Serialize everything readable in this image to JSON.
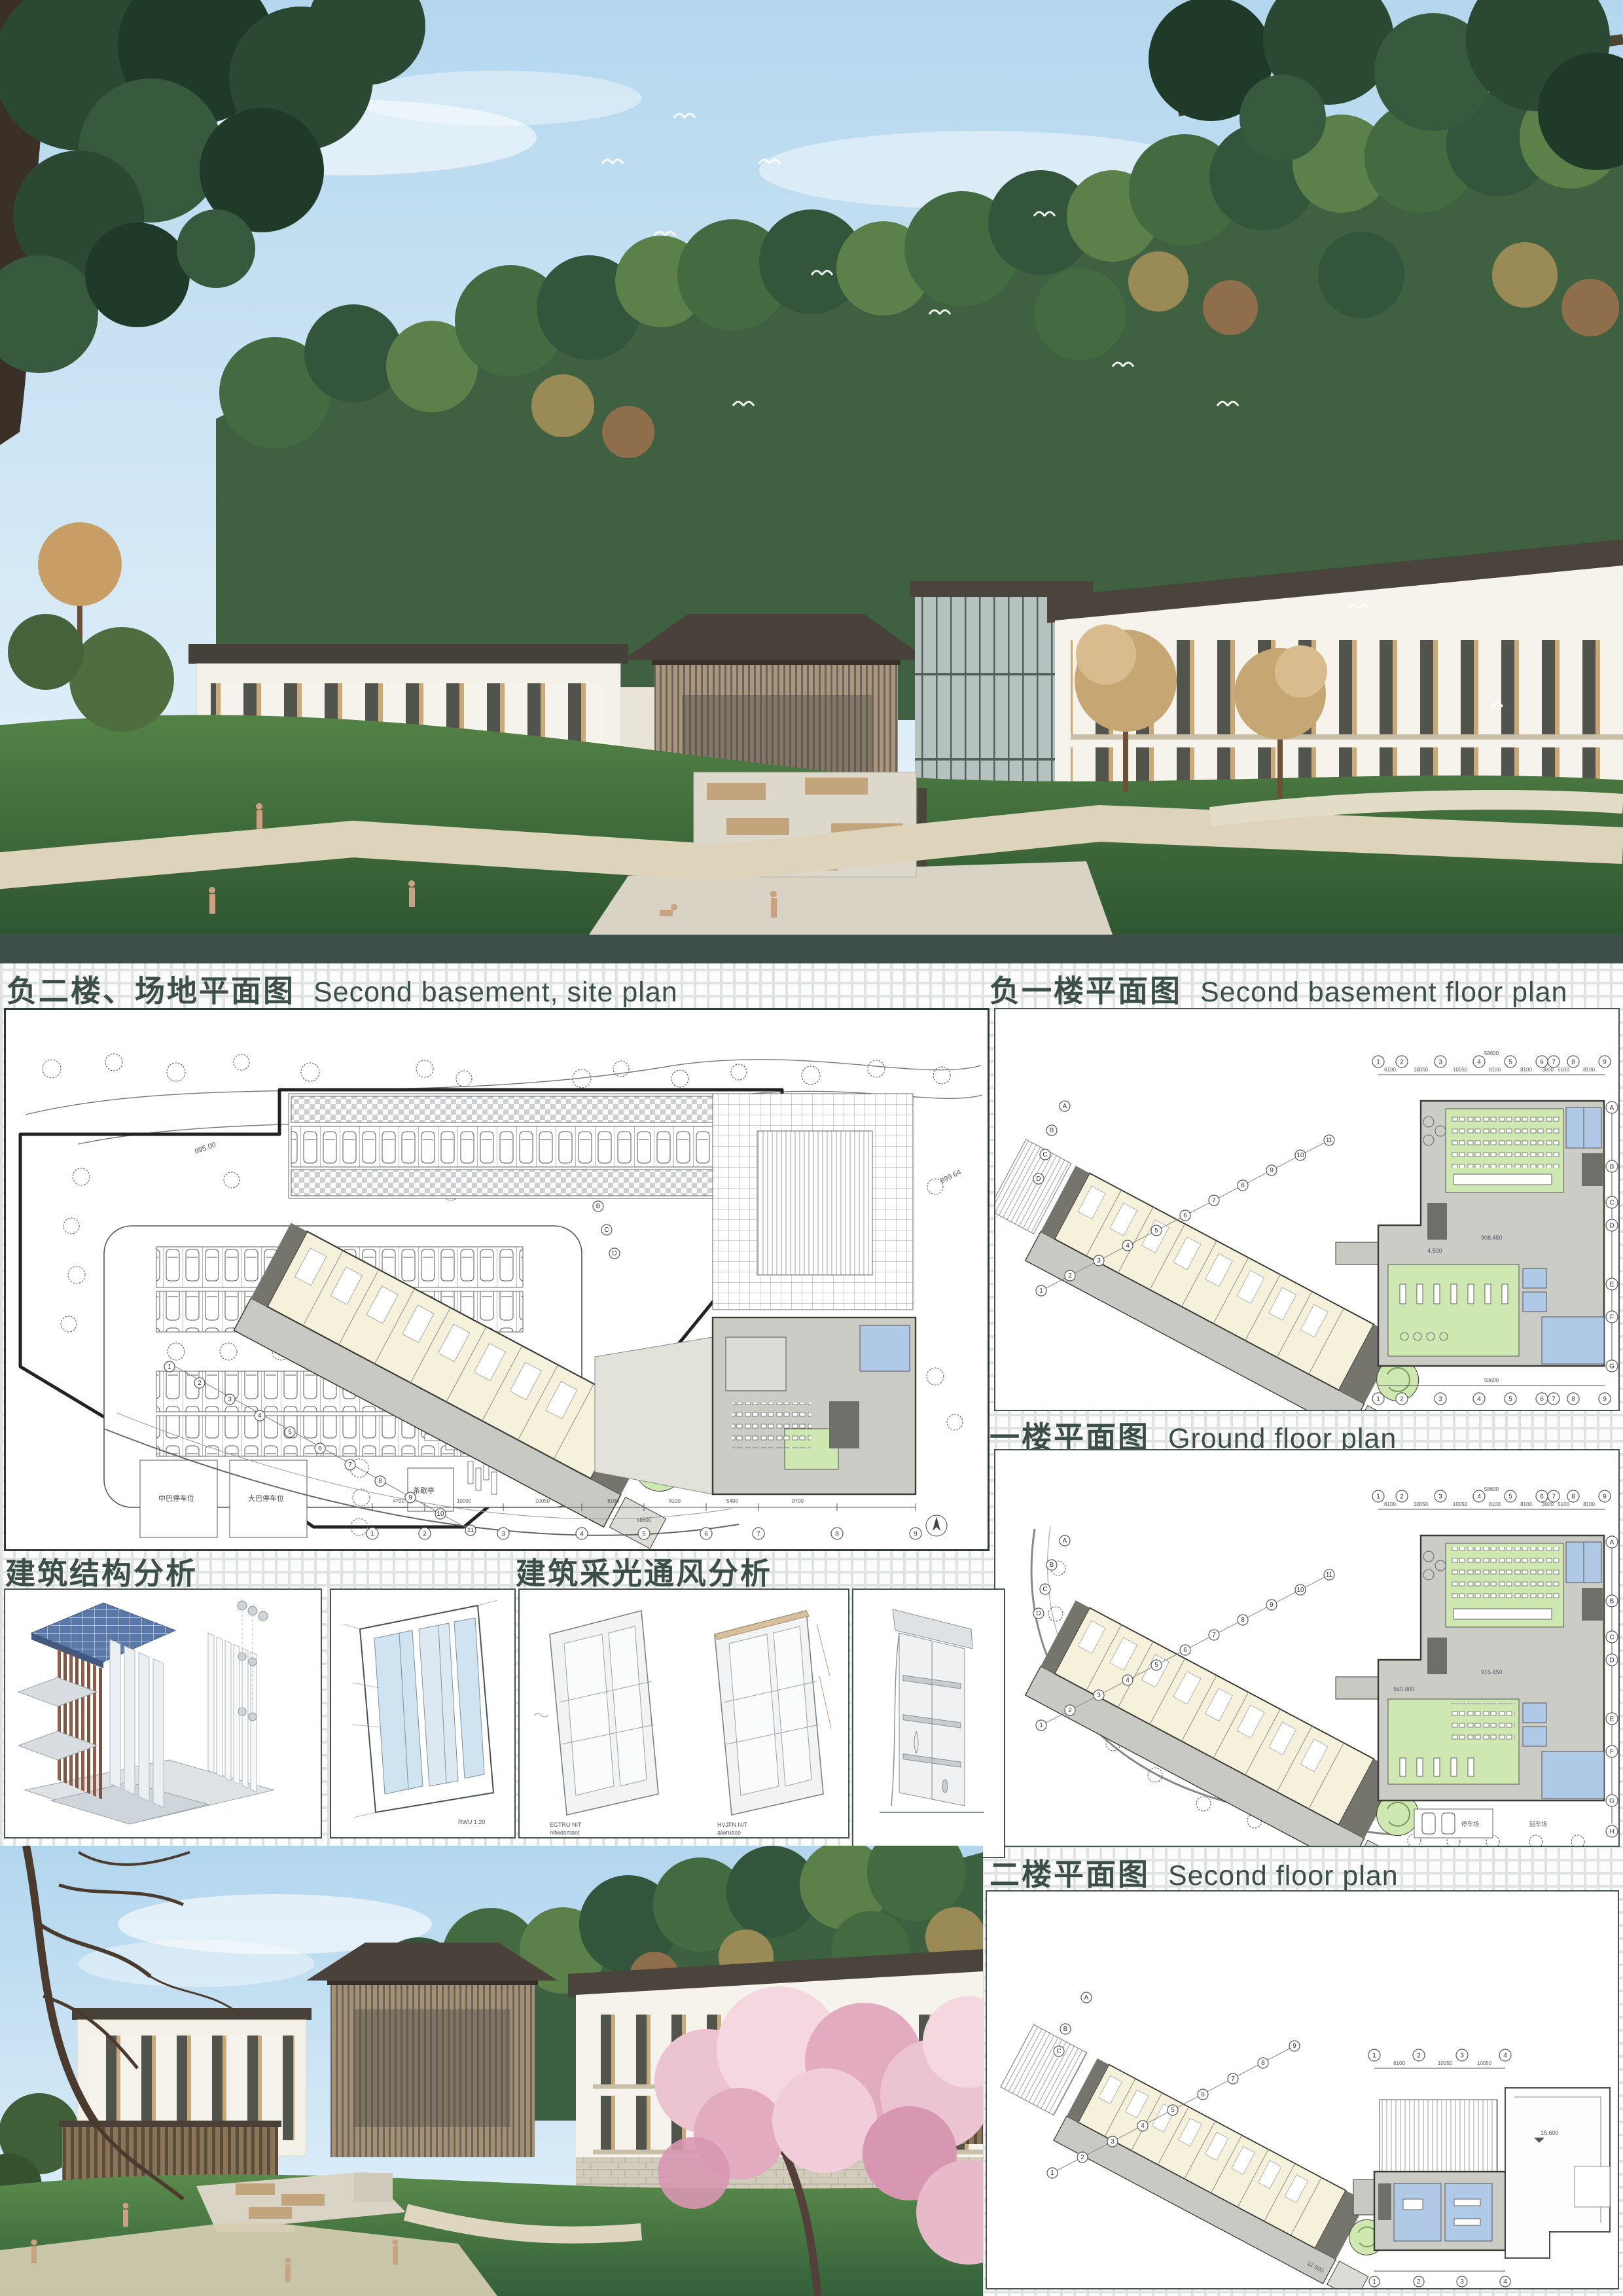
{
  "colors": {
    "divider_teal": "#3e4f4a",
    "title_text": "#3b4e47",
    "grid_line": "#dfe4e0",
    "sky": "#b4d7ee",
    "lawn": "#47713f",
    "blossom_pink": "#ecc3d1",
    "plan_cream": "#f5f1da",
    "plan_green": "#cfe7b1",
    "plan_blue": "#afc9e7",
    "plan_grey": "#c9c9c4"
  },
  "titles": {
    "site_cn": "负二楼、场地平面图",
    "site_en": "Second basement, site plan",
    "b1_cn": "负一楼平面图",
    "b1_en": "Second basement floor plan",
    "ground_cn": "一楼平面图",
    "ground_en": "Ground floor plan",
    "second_cn": "二楼平面图",
    "second_en": "Second floor plan",
    "structure_cn": "建筑结构分析",
    "daylight_cn": "建筑采光通风分析"
  },
  "plans": {
    "nums": [
      "1",
      "2",
      "3",
      "4",
      "5",
      "6",
      "7",
      "8",
      "9",
      "10",
      "11"
    ],
    "letters": [
      "A",
      "B",
      "C",
      "D",
      "E",
      "F",
      "G",
      "H"
    ],
    "dims": [
      "6100",
      "10050",
      "10050",
      "8100",
      "8100",
      "3000",
      "5100",
      "8100"
    ],
    "total": "58600",
    "levels": {
      "l1": "908.450",
      "l2": "915.450",
      "l3": "945.000",
      "l4": "12.600",
      "l5": "15.600",
      "l6": "4.500"
    },
    "labels": {
      "court1": "健身器材场地",
      "court2": "网球场",
      "parking": "停车场",
      "turn": "回车场"
    }
  },
  "site": {
    "contours": [
      "902.07",
      "901.92",
      "897.23",
      "900.63",
      "899.64",
      "895.00"
    ],
    "labels": {
      "bus_mid": "中巴停车位",
      "bus_big": "大巴停车位",
      "pavilion": "茶歇亭"
    },
    "dims": [
      "4700",
      "10000",
      "10050",
      "8100",
      "8100",
      "5400",
      "9700"
    ],
    "total": "58600"
  },
  "analysis": {
    "scale_note": "RWU 1:20",
    "tag1a": "EGTRU NIT",
    "tag1b": "nifwdsmant",
    "tag2a": "HVJFN NIT",
    "tag2b": "alwruaso"
  }
}
